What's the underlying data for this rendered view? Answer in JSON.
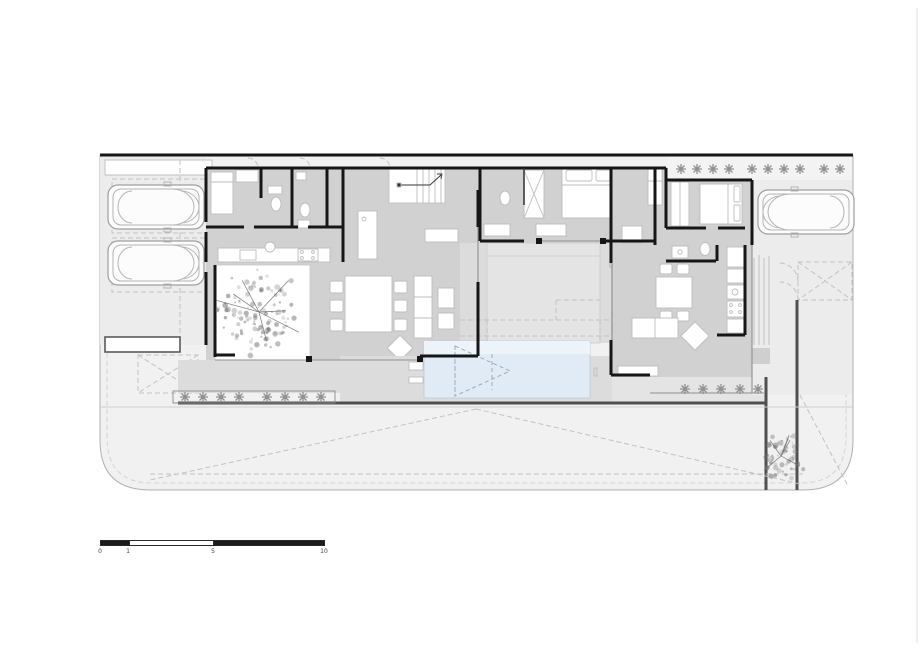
{
  "document": {
    "kind": "architectural ground-floor site plan"
  },
  "scale_bar": {
    "labels": [
      "0",
      "1",
      "5",
      "10"
    ]
  },
  "colors": {
    "wall": "#161616",
    "floor": "#d1d1d1",
    "terrace": "#dcdcdc",
    "site": "#f1f1f1",
    "pool": "#e0ebf5",
    "pool-light": "#ecf3f9",
    "outline": "#b0b0b0",
    "dash": "#c2c2c2",
    "plant": "#8f8f8f",
    "tree": "#6f6f6f",
    "edge": "#4f4f4f",
    "furniture": "#bdbdbd"
  },
  "icons": {
    "car": "top-view-car",
    "tree": "tree-canopy",
    "plant": "shrub-asterisk",
    "pool": "swimming-pool",
    "stairs": "staircase"
  }
}
